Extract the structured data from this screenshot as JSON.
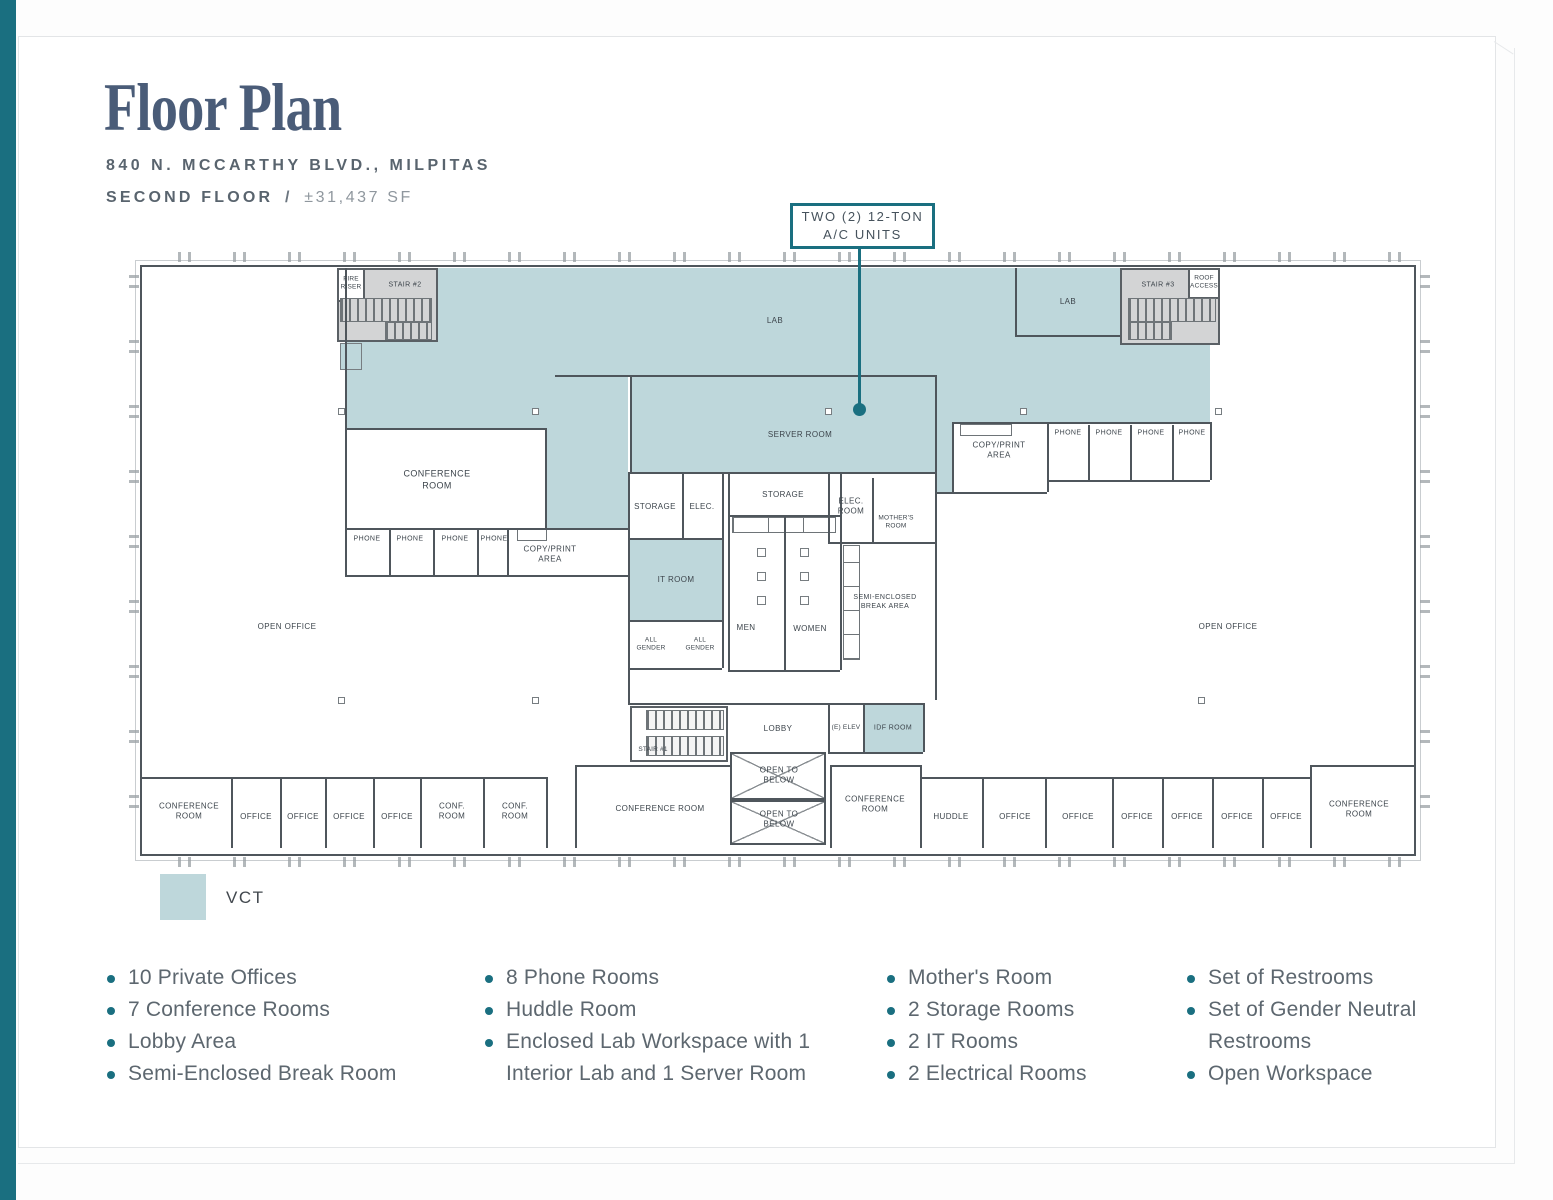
{
  "header": {
    "title": "Floor Plan",
    "address": "840 N. MCCARTHY BLVD., MILPITAS",
    "floor": "SECOND FLOOR",
    "separator": "/",
    "area": "±31,437 SF"
  },
  "callout": {
    "line1": "TWO (2) 12-TON",
    "line2": "A/C UNITS"
  },
  "legend": {
    "vct_label": "VCT"
  },
  "colors": {
    "accent": "#1A6F80",
    "vct_fill": "#BED7DB"
  },
  "plan": {
    "labels": {
      "lab": "LAB",
      "server_room": "SERVER ROOM",
      "open_office": "OPEN OFFICE",
      "conference_room": "CONFERENCE ROOM",
      "conf_room": "CONF. ROOM",
      "office": "OFFICE",
      "phone": "PHONE",
      "copy_print": "COPY/PRINT AREA",
      "storage": "STORAGE",
      "elec": "ELEC.",
      "elec_room": "ELEC. ROOM",
      "mothers_room": "MOTHER'S ROOM",
      "it_room": "IT ROOM",
      "all_gender": "ALL GENDER",
      "men": "MEN",
      "women": "WOMEN",
      "break_area": "SEMI-ENCLOSED BREAK AREA",
      "lobby": "LOBBY",
      "elevator": "(E) ELEV",
      "idf_room": "IDF ROOM",
      "open_below": "OPEN TO BELOW",
      "huddle": "HUDDLE",
      "stair1": "STAIR #1",
      "stair2": "STAIR #2",
      "stair3": "STAIR #3",
      "fire_riser": "FIRE RISER",
      "roof_access": "ROOF ACCESS"
    }
  },
  "features": {
    "col1": [
      "10 Private Offices",
      "7 Conference Rooms",
      "Lobby Area",
      "Semi-Enclosed Break Room"
    ],
    "col2": [
      "8 Phone Rooms",
      "Huddle Room",
      "Enclosed Lab Workspace with 1 Interior Lab and 1 Server Room"
    ],
    "col3": [
      "Mother's Room",
      "2 Storage Rooms",
      "2 IT Rooms",
      "2 Electrical Rooms"
    ],
    "col4": [
      "Set of Restrooms",
      "Set of Gender Neutral Restrooms",
      "Open Workspace"
    ]
  }
}
